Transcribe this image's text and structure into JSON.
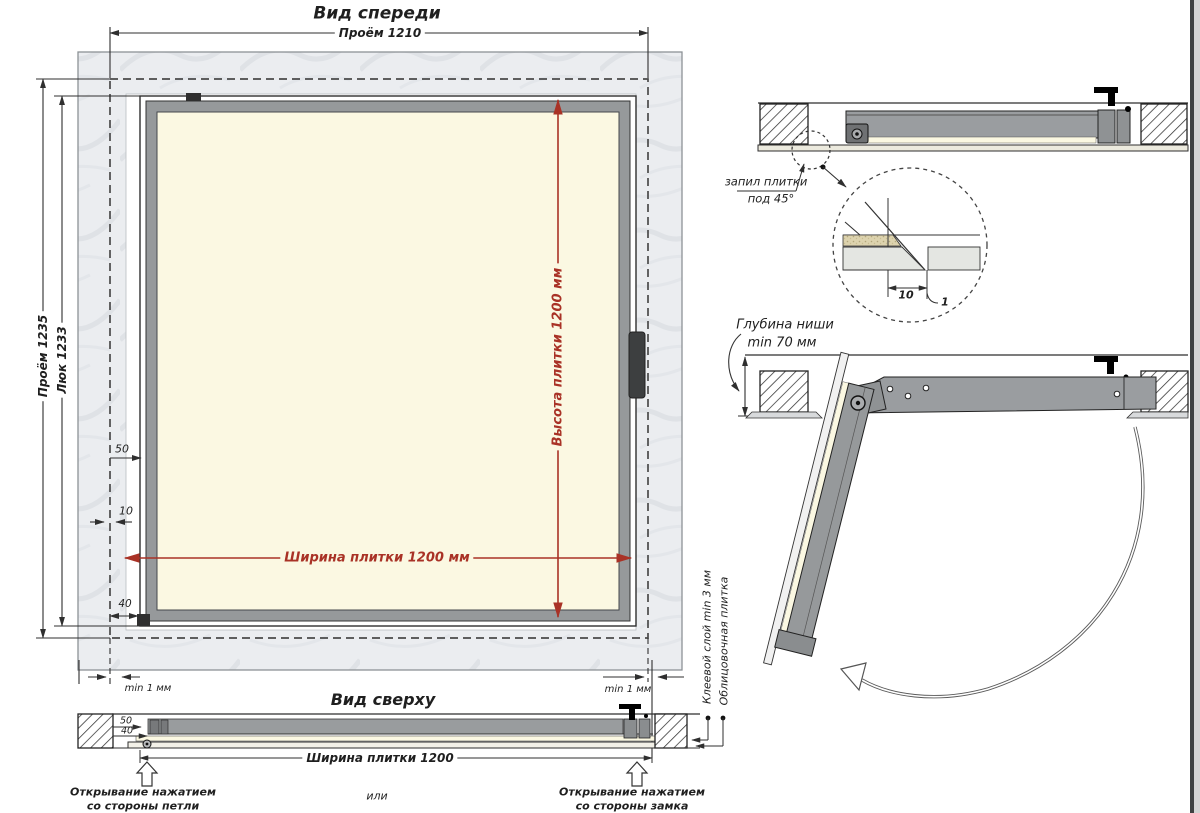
{
  "colors": {
    "accent_red": "#a93226",
    "line": "#2f2f2f",
    "wall_fill": "#ebedf0",
    "frame_gray": "#96999b",
    "tile_cream": "#fbf8e2"
  },
  "front_view": {
    "title": "Вид спереди",
    "dim_opening_width": "Проём 1210",
    "dim_opening_height": "Проём 1235",
    "dim_hatch_height": "Люк 1233",
    "dim_tile_height": "Высота плитки 1200 мм",
    "dim_tile_width": "Ширина плитки 1200 мм",
    "dim_50": "50",
    "dim_10": "10",
    "dim_40": "40",
    "dim_min_gap_left": "min 1 мм",
    "dim_min_gap_right": "min 1 мм"
  },
  "top_view": {
    "title": "Вид сверху",
    "dim_50": "50",
    "dim_40": "40",
    "dim_tile_width": "Ширина плитки 1200",
    "label_open_hinge_line1": "Открывание нажатием",
    "label_open_hinge_line2": "со стороны петли",
    "label_or": "или",
    "label_open_lock_line1": "Открывание нажатием",
    "label_open_lock_line2": "со стороны замка",
    "label_adhesive": "Клеевой слой min 3 мм",
    "label_tile": "Облицовочная плитка"
  },
  "section_closed": {
    "label_cut_line1": "запил плитки",
    "label_cut_line2": "под 45°",
    "detail_dim_10": "10",
    "detail_dim_1": "1"
  },
  "section_open": {
    "label_depth_line1": "Глубина ниши",
    "label_depth_line2": "min 70 мм"
  }
}
